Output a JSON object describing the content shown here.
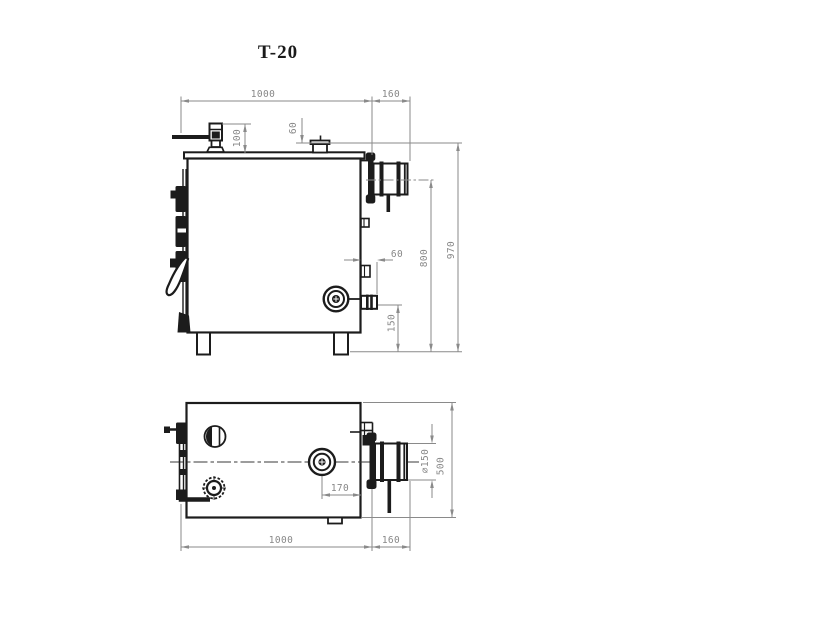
{
  "title": "T-20",
  "colors": {
    "drawing_line": "#1c1c1c",
    "dimension": "#878787"
  },
  "side_view": {
    "dim_width": "1000",
    "dim_flue_extension": "160",
    "dim_valve_height": "100",
    "dim_cap_height": "60",
    "dim_overall_height": "970",
    "dim_flue_axis_height": "800",
    "dim_drain_axis_height": "150",
    "dim_stub_length": "60"
  },
  "plan_view": {
    "dim_width": "1000",
    "dim_flue_extension": "160",
    "dim_depth": "500",
    "dim_flue_diameter": "⌀150",
    "dim_flue_offset": "170"
  }
}
